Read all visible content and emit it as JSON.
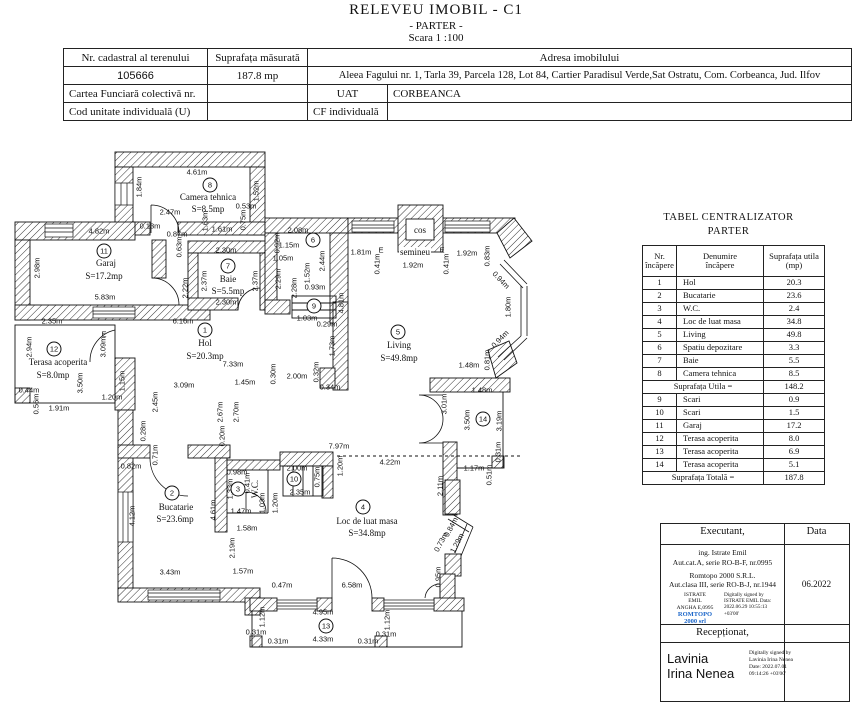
{
  "title": {
    "line1": "RELEVEU  IMOBIL - C1",
    "line2": "- PARTER -",
    "line3": "Scara 1 :100"
  },
  "colors": {
    "ink": "#111111",
    "stamp_blue": "#1b66c9",
    "paper": "#ffffff"
  },
  "info_table": {
    "nr_cadastral_label": "Nr. cadastral al terenului",
    "nr_cadastral_value": "105666",
    "suprafata_label": "Suprafața măsurată",
    "suprafata_value": "187.8 mp",
    "adresa_label": "Adresa imobilului",
    "adresa_value": "Aleea Fagului nr. 1, Tarla 39, Parcela 128, Lot 84, Cartier Paradisul Verde,Sat Ostratu, Com. Corbeanca, Jud. Ilfov",
    "cartea_label": "Cartea Funciară colectivă nr.",
    "uat_label": "UAT",
    "uat_value": "CORBEANCA",
    "cod_label": "Cod unitate individuală (U)",
    "cf_label": "CF individuală"
  },
  "centralizator": {
    "title": "TABEL CENTRALIZATOR",
    "subtitle": "PARTER",
    "headers": [
      [
        "Nr.",
        "încăpere"
      ],
      [
        "Denumire",
        "încăpere"
      ],
      [
        "Suprafața utila",
        "(mp)"
      ]
    ],
    "rows": [
      [
        "1",
        "Hol",
        "20.3"
      ],
      [
        "2",
        "Bucatarie",
        "23.6"
      ],
      [
        "3",
        "W.C.",
        "2.4"
      ],
      [
        "4",
        "Loc de luat masa",
        "34.8"
      ],
      [
        "5",
        "Living",
        "49.8"
      ],
      [
        "6",
        "Spatiu depozitare",
        "3.3"
      ],
      [
        "7",
        "Baie",
        "5.5"
      ],
      [
        "8",
        "Camera tehnica",
        "8.5"
      ]
    ],
    "subtotal_label": "Suprafața Utila  =",
    "subtotal_value": "148.2",
    "rows2": [
      [
        "9",
        "Scari",
        "0.9"
      ],
      [
        "10",
        "Scari",
        "1.5"
      ],
      [
        "11",
        "Garaj",
        "17.2"
      ],
      [
        "12",
        "Terasa acoperita",
        "8.0"
      ],
      [
        "13",
        "Terasa acoperita",
        "6.9"
      ],
      [
        "14",
        "Terasa acoperita",
        "5.1"
      ]
    ],
    "total_label": "Suprafața Totală =",
    "total_value": "187.8"
  },
  "signature": {
    "executant_label": "Executant,",
    "data_label": "Data",
    "line1": "ing. Istrate Emil",
    "line2": "Aut.cat.A, serie RO-B-F, nr.0995",
    "line3": "Romtopo 2000 S.R.L.",
    "line4": "Aut.clasa III, serie RO-B-J, nr.1944",
    "stamp_name1": "ISTRATE",
    "stamp_name2": "EMIL",
    "stamp_name3": "ANGHA E,0995",
    "stamp_brand1": "ROMTOPO",
    "stamp_brand2": "2000 srl",
    "stamp_right": "Digitally signed by ISTRATE EMIL Data: 2022.06.29 10:55:13 +03'00'",
    "data_value": "06.2022",
    "receptionat_label": "Recepționat,",
    "receptionat_name1": "Lavinia",
    "receptionat_name2": "Irina Nenea",
    "receptionat_stamp": "Digitally signed by Lavinia Irina Nenea Date: 2022.07.01 09:14:26 +03'00'"
  },
  "plan": {
    "rooms": [
      {
        "n": "1",
        "x": 205,
        "y": 330
      },
      {
        "n": "2",
        "x": 172,
        "y": 493
      },
      {
        "n": "3",
        "x": 238,
        "y": 489
      },
      {
        "n": "4",
        "x": 363,
        "y": 507
      },
      {
        "n": "5",
        "x": 398,
        "y": 332
      },
      {
        "n": "6",
        "x": 313,
        "y": 240
      },
      {
        "n": "7",
        "x": 228,
        "y": 266
      },
      {
        "n": "8",
        "x": 210,
        "y": 185
      },
      {
        "n": "9",
        "x": 314,
        "y": 306
      },
      {
        "n": "10",
        "x": 294,
        "y": 479
      },
      {
        "n": "11",
        "x": 104,
        "y": 251
      },
      {
        "n": "12",
        "x": 54,
        "y": 349
      },
      {
        "n": "13",
        "x": 326,
        "y": 626
      },
      {
        "n": "14",
        "x": 483,
        "y": 419
      }
    ],
    "labels": [
      {
        "t": "4.61m",
        "x": 197,
        "y": 172
      },
      {
        "t": "1.84m",
        "x": 139,
        "y": 187,
        "r": -90
      },
      {
        "t": "2.47m",
        "x": 170,
        "y": 212
      },
      {
        "t": "0.13m",
        "x": 150,
        "y": 226
      },
      {
        "t": "0.87m",
        "x": 177,
        "y": 234
      },
      {
        "t": "1.61m",
        "x": 222,
        "y": 229
      },
      {
        "t": "0.53m",
        "x": 246,
        "y": 206
      },
      {
        "t": "1.52m",
        "x": 256,
        "y": 191,
        "r": -90
      },
      {
        "t": "0.75m",
        "x": 243,
        "y": 220,
        "r": -90
      },
      {
        "t": "1.63m",
        "x": 205,
        "y": 221,
        "r": -90
      },
      {
        "t": "Camera tehnica",
        "x": 208,
        "y": 197,
        "k": "n"
      },
      {
        "t": "S=8.5mp",
        "x": 208,
        "y": 209,
        "k": "n"
      },
      {
        "t": "0.63m",
        "x": 179,
        "y": 247,
        "r": -90
      },
      {
        "t": "2.22m",
        "x": 185,
        "y": 288,
        "r": -90
      },
      {
        "t": "4.82m",
        "x": 99,
        "y": 231
      },
      {
        "t": "2.98m",
        "x": 37,
        "y": 268,
        "r": -90
      },
      {
        "t": "5.83m",
        "x": 105,
        "y": 297
      },
      {
        "t": "2.35m",
        "x": 52,
        "y": 321
      },
      {
        "t": "Garaj",
        "x": 106,
        "y": 263,
        "k": "n"
      },
      {
        "t": "S=17.2mp",
        "x": 104,
        "y": 276,
        "k": "n"
      },
      {
        "t": "2.30m",
        "x": 226,
        "y": 250
      },
      {
        "t": "2.37m",
        "x": 204,
        "y": 281,
        "r": -90
      },
      {
        "t": "2.37m",
        "x": 255,
        "y": 281,
        "r": -90
      },
      {
        "t": "2.30m",
        "x": 226,
        "y": 302
      },
      {
        "t": "Baie",
        "x": 228,
        "y": 279,
        "k": "n"
      },
      {
        "t": "S=5.5mp",
        "x": 228,
        "y": 291,
        "k": "n"
      },
      {
        "t": "6.16m",
        "x": 183,
        "y": 321
      },
      {
        "t": "2.08m",
        "x": 298,
        "y": 230
      },
      {
        "t": "0.92m",
        "x": 277,
        "y": 243,
        "r": -90
      },
      {
        "t": "1.15m",
        "x": 289,
        "y": 245
      },
      {
        "t": "1.05m",
        "x": 283,
        "y": 258
      },
      {
        "t": "2.29m",
        "x": 278,
        "y": 279,
        "r": -90
      },
      {
        "t": "2.28m",
        "x": 294,
        "y": 288,
        "r": -90
      },
      {
        "t": "1.52m",
        "x": 307,
        "y": 273,
        "r": -90
      },
      {
        "t": "0.93m",
        "x": 315,
        "y": 287
      },
      {
        "t": "2.44m",
        "x": 322,
        "y": 261,
        "r": -90
      },
      {
        "t": "1.03m",
        "x": 307,
        "y": 318
      },
      {
        "t": "0.29m",
        "x": 327,
        "y": 324
      },
      {
        "t": "4.81m",
        "x": 341,
        "y": 303,
        "r": -90
      },
      {
        "t": "Hol",
        "x": 205,
        "y": 343,
        "k": "n"
      },
      {
        "t": "S=20.3mp",
        "x": 205,
        "y": 356,
        "k": "n"
      },
      {
        "t": "7.33m",
        "x": 233,
        "y": 364
      },
      {
        "t": "3.09m",
        "x": 184,
        "y": 385
      },
      {
        "t": "1.45m",
        "x": 245,
        "y": 382
      },
      {
        "t": "0.30m",
        "x": 273,
        "y": 374,
        "r": -90
      },
      {
        "t": "2.00m",
        "x": 297,
        "y": 376
      },
      {
        "t": "1.73m",
        "x": 332,
        "y": 346,
        "r": -90
      },
      {
        "t": "0.32m",
        "x": 316,
        "y": 372,
        "r": -90
      },
      {
        "t": "0.34m",
        "x": 330,
        "y": 387
      },
      {
        "t": "2.67m",
        "x": 220,
        "y": 412,
        "r": -90
      },
      {
        "t": "2.70m",
        "x": 236,
        "y": 412,
        "r": -90
      },
      {
        "t": "0.20m",
        "x": 222,
        "y": 436,
        "r": -90
      },
      {
        "t": "2.94m",
        "x": 29,
        "y": 347,
        "r": -90
      },
      {
        "t": "Terasa acoperita",
        "x": 58,
        "y": 362,
        "k": "n"
      },
      {
        "t": "S=8.0mp",
        "x": 53,
        "y": 375,
        "k": "n"
      },
      {
        "t": "3.09m",
        "x": 103,
        "y": 347,
        "r": -90
      },
      {
        "t": "3.50m",
        "x": 80,
        "y": 383,
        "r": -90
      },
      {
        "t": "0.44m",
        "x": 29,
        "y": 390
      },
      {
        "t": "0.56m",
        "x": 36,
        "y": 404,
        "r": -90
      },
      {
        "t": "1.91m",
        "x": 59,
        "y": 408
      },
      {
        "t": "1.20m",
        "x": 112,
        "y": 397
      },
      {
        "t": "1.15m",
        "x": 122,
        "y": 381,
        "r": -90
      },
      {
        "t": "E",
        "x": 104,
        "y": 334
      },
      {
        "t": "2.45m",
        "x": 155,
        "y": 402,
        "r": -90
      },
      {
        "t": "0.28m",
        "x": 143,
        "y": 431,
        "r": -90
      },
      {
        "t": "0.71m",
        "x": 155,
        "y": 455,
        "r": -90
      },
      {
        "t": "0.82m",
        "x": 131,
        "y": 466
      },
      {
        "t": "Bucatarie",
        "x": 176,
        "y": 507,
        "k": "n"
      },
      {
        "t": "S=23.6mp",
        "x": 175,
        "y": 519,
        "k": "n"
      },
      {
        "t": "4.12m",
        "x": 132,
        "y": 516,
        "r": -90
      },
      {
        "t": "3.43m",
        "x": 170,
        "y": 572
      },
      {
        "t": "1.57m",
        "x": 243,
        "y": 571
      },
      {
        "t": "4.61m",
        "x": 213,
        "y": 510,
        "r": -90
      },
      {
        "t": "2.19m",
        "x": 232,
        "y": 548,
        "r": -90
      },
      {
        "t": "0.98m",
        "x": 237,
        "y": 472
      },
      {
        "t": "1.33m",
        "x": 230,
        "y": 489,
        "r": -90
      },
      {
        "t": "0.41m",
        "x": 247,
        "y": 483,
        "r": -90
      },
      {
        "t": "W.C.",
        "x": 255,
        "y": 489,
        "r": -90,
        "k": "n"
      },
      {
        "t": "1.03m",
        "x": 262,
        "y": 503,
        "r": -90
      },
      {
        "t": "1.20m",
        "x": 275,
        "y": 503,
        "r": -90
      },
      {
        "t": "1.47m",
        "x": 241,
        "y": 511
      },
      {
        "t": "1.58m",
        "x": 247,
        "y": 528
      },
      {
        "t": "2.00m",
        "x": 297,
        "y": 468
      },
      {
        "t": "0.75m",
        "x": 317,
        "y": 477,
        "r": -90
      },
      {
        "t": "2.35m",
        "x": 300,
        "y": 492
      },
      {
        "t": "1.20m",
        "x": 340,
        "y": 466,
        "r": -90
      },
      {
        "t": "7.97m",
        "x": 339,
        "y": 446
      },
      {
        "t": "4.22m",
        "x": 390,
        "y": 462
      },
      {
        "t": "Loc de luat masa",
        "x": 367,
        "y": 521,
        "k": "n"
      },
      {
        "t": "S=34.8mp",
        "x": 367,
        "y": 533,
        "k": "n"
      },
      {
        "t": "2.11m",
        "x": 440,
        "y": 486,
        "r": -90
      },
      {
        "t": "0.73m",
        "x": 441,
        "y": 542,
        "r": -62
      },
      {
        "t": "0.84m",
        "x": 451,
        "y": 527,
        "r": -62
      },
      {
        "t": "1.29m",
        "x": 457,
        "y": 543,
        "r": -62
      },
      {
        "t": "0.95m",
        "x": 438,
        "y": 577,
        "r": -90
      },
      {
        "t": "6.58m",
        "x": 352,
        "y": 585
      },
      {
        "t": "0.47m",
        "x": 282,
        "y": 585
      },
      {
        "t": "4.95m",
        "x": 323,
        "y": 612
      },
      {
        "t": "1.12m",
        "x": 262,
        "y": 617,
        "r": -90
      },
      {
        "t": "1.12m",
        "x": 387,
        "y": 620,
        "r": -90
      },
      {
        "t": "4.33m",
        "x": 323,
        "y": 639
      },
      {
        "t": "0.31m",
        "x": 256,
        "y": 632
      },
      {
        "t": "0.31m",
        "x": 278,
        "y": 641
      },
      {
        "t": "0.31m",
        "x": 368,
        "y": 641
      },
      {
        "t": "0.31m",
        "x": 386,
        "y": 634
      },
      {
        "t": "Living",
        "x": 399,
        "y": 345,
        "k": "n"
      },
      {
        "t": "S=49.8mp",
        "x": 399,
        "y": 358,
        "k": "n"
      },
      {
        "t": "1.81m",
        "x": 361,
        "y": 252
      },
      {
        "t": "E",
        "x": 381,
        "y": 250
      },
      {
        "t": "0.41m",
        "x": 377,
        "y": 264,
        "r": -90
      },
      {
        "t": "cos",
        "x": 420,
        "y": 230,
        "k": "n"
      },
      {
        "t": "semineu",
        "x": 415,
        "y": 252,
        "k": "n",
        "b": 1
      },
      {
        "t": "1.92m",
        "x": 413,
        "y": 265
      },
      {
        "t": "0.41m",
        "x": 446,
        "y": 264,
        "r": -90
      },
      {
        "t": "E",
        "x": 442,
        "y": 250
      },
      {
        "t": "1.92m",
        "x": 467,
        "y": 253
      },
      {
        "t": "0.83m",
        "x": 487,
        "y": 256,
        "r": -90
      },
      {
        "t": "0.94m",
        "x": 501,
        "y": 280,
        "r": 46
      },
      {
        "t": "1.80m",
        "x": 508,
        "y": 307,
        "r": -90
      },
      {
        "t": "0.94m",
        "x": 500,
        "y": 339,
        "r": -46
      },
      {
        "t": "0.81m",
        "x": 487,
        "y": 360,
        "r": -90
      },
      {
        "t": "1.48m",
        "x": 469,
        "y": 365
      },
      {
        "t": "1.48m",
        "x": 482,
        "y": 390
      },
      {
        "t": "3.01m",
        "x": 444,
        "y": 404,
        "r": -90
      },
      {
        "t": "3.50m",
        "x": 467,
        "y": 420,
        "r": -90
      },
      {
        "t": "3.19m",
        "x": 499,
        "y": 421,
        "r": -90
      },
      {
        "t": "0.31m",
        "x": 498,
        "y": 452,
        "r": -90
      },
      {
        "t": "1.17m",
        "x": 474,
        "y": 468
      },
      {
        "t": "0.51m",
        "x": 489,
        "y": 475,
        "r": -90
      }
    ]
  }
}
